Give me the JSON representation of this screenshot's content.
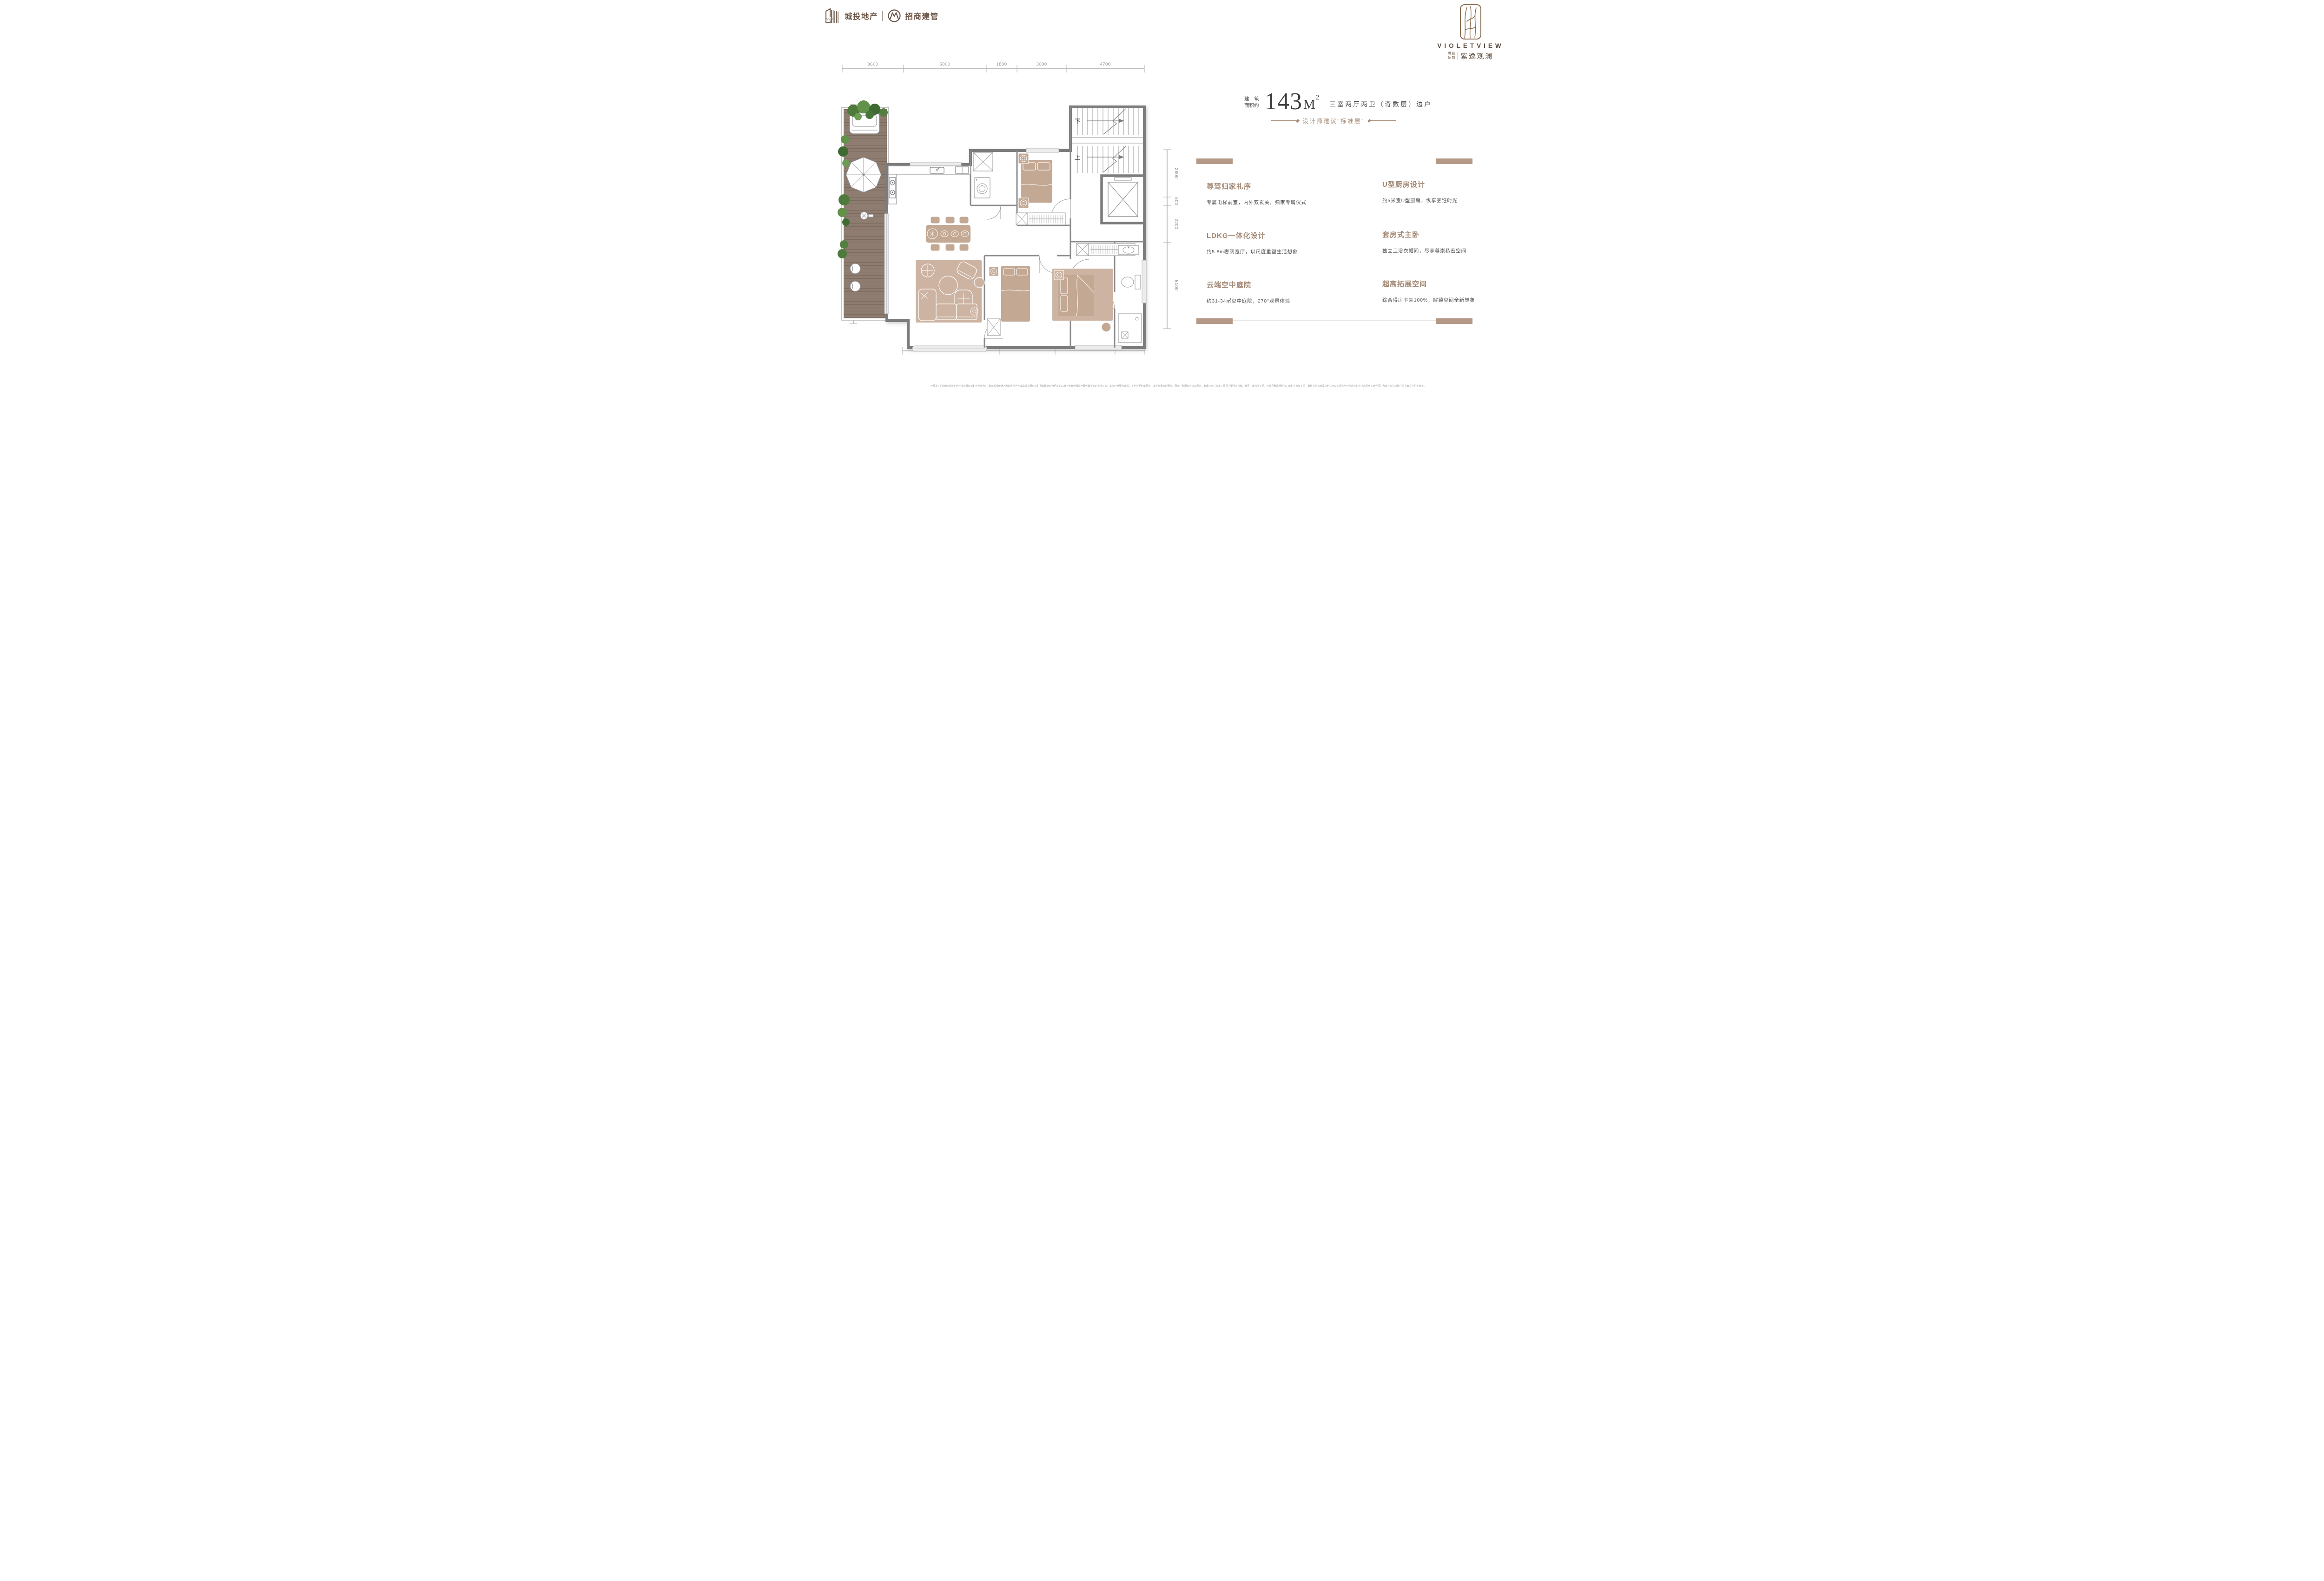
{
  "header": {
    "dev_logo": {
      "ccci": "CCCI",
      "brand1": "城投地产",
      "brand2": "招商建管",
      "color": "#6b5546"
    },
    "brand": {
      "name_en": "VIOLETVIEW",
      "sub_top": "城投",
      "sub_bottom": "招商",
      "name_cn": "紫逸观澜"
    }
  },
  "plan": {
    "dims_top": [
      "3600",
      "5000",
      "1800",
      "3000",
      "4700"
    ],
    "dims_left": [
      "2400",
      "2600",
      "2900",
      "5100"
    ],
    "dims_right": [
      "2800",
      "500",
      "2200",
      "5100"
    ],
    "dims_bottom": [
      "5800",
      "3300",
      "3600",
      "1800"
    ],
    "stair_down": "下",
    "stair_up": "上"
  },
  "info": {
    "area_label_l1": "建筑",
    "area_label_l1_c1": "建",
    "area_label_l1_c2": "筑",
    "area_label_l2": "面积约",
    "area_value": "143",
    "area_unit": "M",
    "area_sup": "2",
    "type_line": "三室两厅两卫（奇数层）边户",
    "designer_note": "设计师建议“标准层”",
    "features": [
      {
        "title": "尊驾归家礼序",
        "desc": "专属电梯前室，内外双玄关，归家专属仪式"
      },
      {
        "title": "U型厨房设计",
        "desc": "约5米宽U型厨房，纵享烹饪时光"
      },
      {
        "title": "LDKG一体化设计",
        "desc": "约5.8m奢阔宽厅，以尺度重塑生活想象"
      },
      {
        "title": "套房式主卧",
        "desc": "独立卫浴衣帽间，尽享尊崇私密空间"
      },
      {
        "title": "云端空中庭院",
        "desc": "约31-34㎡空中庭院，270°观景体验"
      },
      {
        "title": "超高拓展空间",
        "desc": "综合得房率超100%，解锁空间全新想象"
      }
    ]
  },
  "disclaimer": "开展商：【长春城投房地产开发有限公司】开发商为：【长春城投伊通河改造房地产开发建设有限公司】招商建管仅为招商蛇口旗下统筹管理并开展代建业务的专业公司。本资料为要约邀请，不作为要约或承诺；本资料展示的图片、展示户型图仅为意向展示，非最终交付标准，相同户型所在楼栋、楼层、单元等不同，可能导致局部结构、面积等有所不同，最终交付标准及权利义务以买受人与开发商签订的《商品房买卖合同》及其补充协议附件等书面文件约定为准。",
  "colors": {
    "brand_brown": "#6b5546",
    "heading_tan": "#a28874",
    "text_dark": "#4f4f4f",
    "wall_gray": "#7c7c7f",
    "furniture_tan": "#c3a893",
    "rug_tan": "#cdb4a2",
    "deck_brown": "#8d7c6f",
    "plant_green": "#4e7b3c",
    "divider_tan": "#b49a86"
  }
}
